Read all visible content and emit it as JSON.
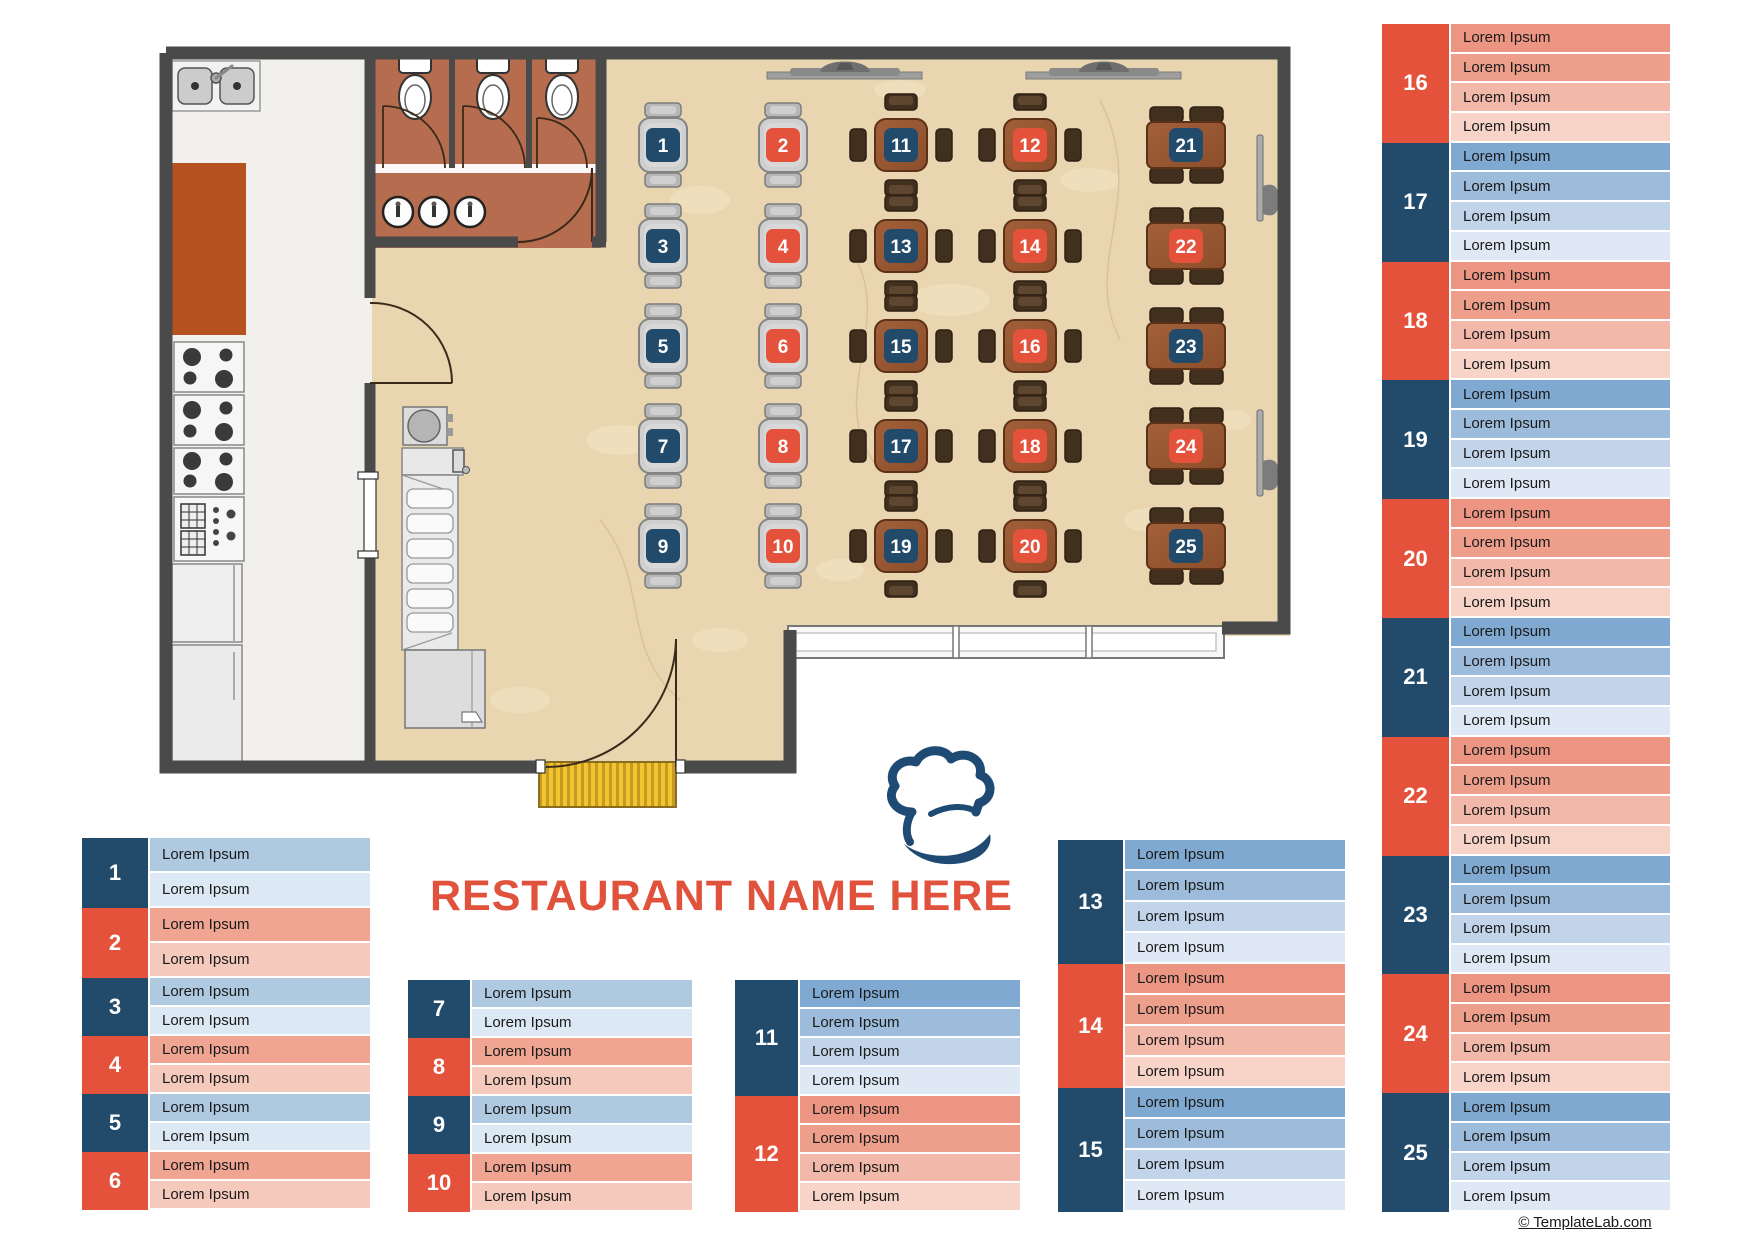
{
  "title": "RESTAURANT NAME HERE",
  "credit_link": "© TemplateLab.com",
  "logo": {
    "icon": "chef-hat-icon"
  },
  "colors": {
    "navy": "#214A6B",
    "red": "#E5523C",
    "title_red": "#E0523C",
    "wall": "#4A4A4A",
    "dining_floor": "#E9D6B1",
    "kitchen_floor": "#F1F0ED",
    "restroom_floor": "#B66C4E",
    "wood_light": "#A2603A",
    "wood_dark": "#8C4E2B",
    "mat_yellow": "#F2C530",
    "row_shades": {
      "blue": [
        "#7FA9D1",
        "#9DBCDB",
        "#C2D4E9",
        "#DFE9F5"
      ],
      "red": [
        "#EC9583",
        "#EE9F8C",
        "#F2B8A9",
        "#F7D3C8"
      ],
      "blue2": [
        "#AFC9E0",
        "#DCE8F4"
      ],
      "red2": [
        "#EFA592",
        "#F5CABD"
      ]
    }
  },
  "floorplan": {
    "tables": [
      {
        "number": "1",
        "kind": "two",
        "color": "blue",
        "x": 663,
        "y": 145
      },
      {
        "number": "2",
        "kind": "two",
        "color": "red",
        "x": 783,
        "y": 145
      },
      {
        "number": "3",
        "kind": "two",
        "color": "blue",
        "x": 663,
        "y": 246
      },
      {
        "number": "4",
        "kind": "two",
        "color": "red",
        "x": 783,
        "y": 246
      },
      {
        "number": "5",
        "kind": "two",
        "color": "blue",
        "x": 663,
        "y": 346
      },
      {
        "number": "6",
        "kind": "two",
        "color": "red",
        "x": 783,
        "y": 346
      },
      {
        "number": "7",
        "kind": "two",
        "color": "blue",
        "x": 663,
        "y": 446
      },
      {
        "number": "8",
        "kind": "two",
        "color": "red",
        "x": 783,
        "y": 446
      },
      {
        "number": "9",
        "kind": "two",
        "color": "blue",
        "x": 663,
        "y": 546
      },
      {
        "number": "10",
        "kind": "two",
        "color": "red",
        "x": 783,
        "y": 546
      },
      {
        "number": "11",
        "kind": "four",
        "color": "blue",
        "x": 901,
        "y": 145
      },
      {
        "number": "12",
        "kind": "four",
        "color": "red",
        "x": 1030,
        "y": 145
      },
      {
        "number": "13",
        "kind": "four",
        "color": "blue",
        "x": 901,
        "y": 246
      },
      {
        "number": "14",
        "kind": "four",
        "color": "red",
        "x": 1030,
        "y": 246
      },
      {
        "number": "15",
        "kind": "four",
        "color": "blue",
        "x": 901,
        "y": 346
      },
      {
        "number": "16",
        "kind": "four",
        "color": "red",
        "x": 1030,
        "y": 346
      },
      {
        "number": "17",
        "kind": "four",
        "color": "blue",
        "x": 901,
        "y": 446
      },
      {
        "number": "18",
        "kind": "four",
        "color": "red",
        "x": 1030,
        "y": 446
      },
      {
        "number": "19",
        "kind": "four",
        "color": "blue",
        "x": 901,
        "y": 546
      },
      {
        "number": "20",
        "kind": "four",
        "color": "red",
        "x": 1030,
        "y": 546
      },
      {
        "number": "21",
        "kind": "wide",
        "color": "blue",
        "x": 1186,
        "y": 145
      },
      {
        "number": "22",
        "kind": "wide",
        "color": "red",
        "x": 1186,
        "y": 246
      },
      {
        "number": "23",
        "kind": "wide",
        "color": "blue",
        "x": 1186,
        "y": 346
      },
      {
        "number": "24",
        "kind": "wide",
        "color": "red",
        "x": 1186,
        "y": 446
      },
      {
        "number": "25",
        "kind": "wide",
        "color": "blue",
        "x": 1186,
        "y": 546
      }
    ]
  },
  "legends": [
    {
      "name": "tables-1-6",
      "x": 82,
      "y": 838,
      "num_width": 66,
      "row_width": 222,
      "row_height": 29,
      "blocks": [
        {
          "number": "1",
          "color": "blue",
          "row_height": 35,
          "rows": [
            "Lorem Ipsum",
            "Lorem Ipsum"
          ]
        },
        {
          "number": "2",
          "color": "red",
          "row_height": 35,
          "rows": [
            "Lorem Ipsum",
            "Lorem Ipsum"
          ]
        },
        {
          "number": "3",
          "color": "blue",
          "rows": [
            "Lorem Ipsum",
            "Lorem Ipsum"
          ]
        },
        {
          "number": "4",
          "color": "red",
          "rows": [
            "Lorem Ipsum",
            "Lorem Ipsum"
          ]
        },
        {
          "number": "5",
          "color": "blue",
          "rows": [
            "Lorem Ipsum",
            "Lorem Ipsum"
          ]
        },
        {
          "number": "6",
          "color": "red",
          "rows": [
            "Lorem Ipsum",
            "Lorem Ipsum"
          ]
        }
      ]
    },
    {
      "name": "tables-7-10",
      "x": 408,
      "y": 980,
      "num_width": 62,
      "row_width": 222,
      "row_height": 29,
      "blocks": [
        {
          "number": "7",
          "color": "blue",
          "rows": [
            "Lorem Ipsum",
            "Lorem Ipsum"
          ]
        },
        {
          "number": "8",
          "color": "red",
          "rows": [
            "Lorem Ipsum",
            "Lorem Ipsum"
          ]
        },
        {
          "number": "9",
          "color": "blue",
          "rows": [
            "Lorem Ipsum",
            "Lorem Ipsum"
          ]
        },
        {
          "number": "10",
          "color": "red",
          "rows": [
            "Lorem Ipsum",
            "Lorem Ipsum"
          ]
        }
      ]
    },
    {
      "name": "tables-11-12",
      "x": 735,
      "y": 980,
      "num_width": 63,
      "row_width": 222,
      "row_height": 29,
      "blocks": [
        {
          "number": "11",
          "color": "blue",
          "rows": [
            "Lorem Ipsum",
            "Lorem Ipsum",
            "Lorem Ipsum",
            "Lorem Ipsum"
          ]
        },
        {
          "number": "12",
          "color": "red",
          "rows": [
            "Lorem Ipsum",
            "Lorem Ipsum",
            "Lorem Ipsum",
            "Lorem Ipsum"
          ]
        }
      ]
    },
    {
      "name": "tables-13-15",
      "x": 1058,
      "y": 840,
      "num_width": 65,
      "row_width": 222,
      "row_height": 31,
      "blocks": [
        {
          "number": "13",
          "color": "blue",
          "rows": [
            "Lorem Ipsum",
            "Lorem Ipsum",
            "Lorem Ipsum",
            "Lorem Ipsum"
          ]
        },
        {
          "number": "14",
          "color": "red",
          "rows": [
            "Lorem Ipsum",
            "Lorem Ipsum",
            "Lorem Ipsum",
            "Lorem Ipsum"
          ]
        },
        {
          "number": "15",
          "color": "blue",
          "rows": [
            "Lorem Ipsum",
            "Lorem Ipsum",
            "Lorem Ipsum",
            "Lorem Ipsum"
          ]
        }
      ]
    },
    {
      "name": "tables-16-25",
      "x": 1382,
      "y": 24,
      "num_width": 67,
      "row_width": 221,
      "row_height": 29.7,
      "blocks": [
        {
          "number": "16",
          "color": "red",
          "rows": [
            "Lorem Ipsum",
            "Lorem Ipsum",
            "Lorem Ipsum",
            "Lorem Ipsum"
          ]
        },
        {
          "number": "17",
          "color": "blue",
          "rows": [
            "Lorem Ipsum",
            "Lorem Ipsum",
            "Lorem Ipsum",
            "Lorem Ipsum"
          ]
        },
        {
          "number": "18",
          "color": "red",
          "rows": [
            "Lorem Ipsum",
            "Lorem Ipsum",
            "Lorem Ipsum",
            "Lorem Ipsum"
          ]
        },
        {
          "number": "19",
          "color": "blue",
          "rows": [
            "Lorem Ipsum",
            "Lorem Ipsum",
            "Lorem Ipsum",
            "Lorem Ipsum"
          ]
        },
        {
          "number": "20",
          "color": "red",
          "rows": [
            "Lorem Ipsum",
            "Lorem Ipsum",
            "Lorem Ipsum",
            "Lorem Ipsum"
          ]
        },
        {
          "number": "21",
          "color": "blue",
          "rows": [
            "Lorem Ipsum",
            "Lorem Ipsum",
            "Lorem Ipsum",
            "Lorem Ipsum"
          ]
        },
        {
          "number": "22",
          "color": "red",
          "rows": [
            "Lorem Ipsum",
            "Lorem Ipsum",
            "Lorem Ipsum",
            "Lorem Ipsum"
          ]
        },
        {
          "number": "23",
          "color": "blue",
          "rows": [
            "Lorem Ipsum",
            "Lorem Ipsum",
            "Lorem Ipsum",
            "Lorem Ipsum"
          ]
        },
        {
          "number": "24",
          "color": "red",
          "rows": [
            "Lorem Ipsum",
            "Lorem Ipsum",
            "Lorem Ipsum",
            "Lorem Ipsum"
          ]
        },
        {
          "number": "25",
          "color": "blue",
          "rows": [
            "Lorem Ipsum",
            "Lorem Ipsum",
            "Lorem Ipsum",
            "Lorem Ipsum"
          ]
        }
      ]
    }
  ]
}
